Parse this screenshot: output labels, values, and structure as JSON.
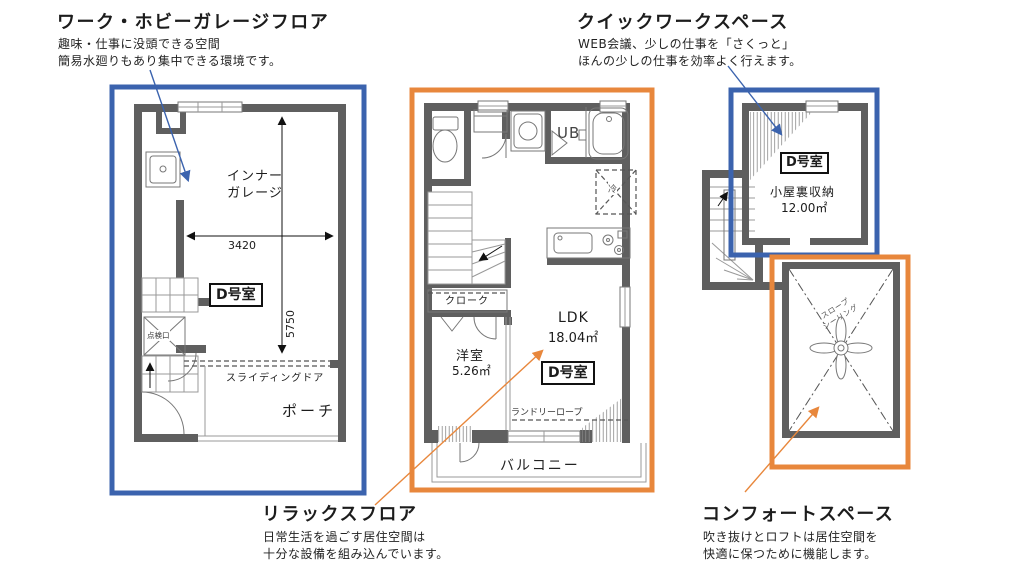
{
  "colors": {
    "blue": "#3b63ae",
    "orange": "#e8873c",
    "wall": "#5f5f5f",
    "line": "#777777",
    "text": "#1a1a1a"
  },
  "annotations": {
    "work_garage": {
      "title": "ワーク・ホビーガレージフロア",
      "desc_line1": "趣味・仕事に没頭できる空間",
      "desc_line2": "簡易水廻りもあり集中できる環境です。"
    },
    "quick_work": {
      "title": "クイックワークスペース",
      "desc_line1": "WEB会議、少しの仕事を「さくっと」",
      "desc_line2": "ほんの少しの仕事を効率よく行えます。"
    },
    "relax": {
      "title": "リラックスフロア",
      "desc_line1": "日常生活を過ごす居住空間は",
      "desc_line2": "十分な設備を組み込んでいます。"
    },
    "comfort": {
      "title": "コンフォートスペース",
      "desc_line1": "吹き抜けとロフトは居住空間を",
      "desc_line2": "快適に保つために機能します。"
    }
  },
  "garage_floor": {
    "room_line1": "インナー",
    "room_line2": "ガレージ",
    "unit": "D号室",
    "width_mm": "3420",
    "depth_mm": "5750",
    "hatch": "点検口",
    "sliding_door": "スライディングドア",
    "porch": "ポーチ"
  },
  "relax_floor": {
    "unit": "D号室",
    "bath": "UB",
    "fridge": "冷",
    "cloak": "クローク",
    "west_room": "洋室",
    "west_room_area": "5.26㎡",
    "ldk": "LDK",
    "ldk_area": "18.04㎡",
    "laundry_rope": "ランドリーロープ",
    "balcony": "バルコニー"
  },
  "loft_floor": {
    "unit": "D号室",
    "attic": "小屋裏収納",
    "attic_area": "12.00㎡",
    "slope_line1": "スロープ",
    "slope_line2": "シーリング"
  }
}
